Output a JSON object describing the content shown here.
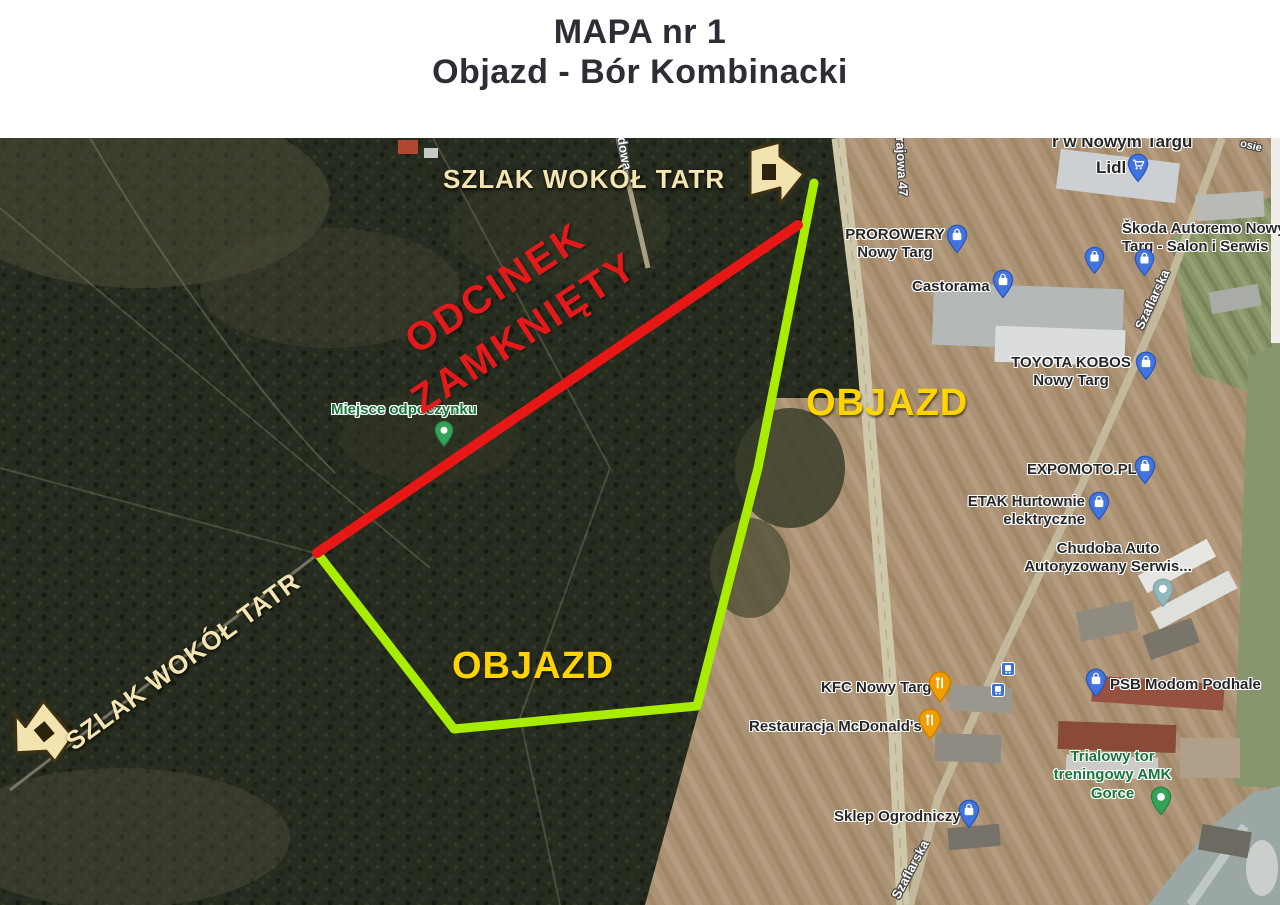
{
  "title": {
    "line1": "MAPA nr 1",
    "line2": "Objazd - Bór Kombinacki"
  },
  "annotations": {
    "trail_top": "SZLAK WOKÓŁ TATR",
    "trail_bottom": "SZLAK WOKÓŁ TATR",
    "closed_line1": "ODCINEK",
    "closed_line2": "ZAMKNIĘTY",
    "detour_east": "OBJAZD",
    "detour_south": "OBJAZD"
  },
  "colors": {
    "closed_section_line": "#e71715",
    "detour_line": "#a8ec00",
    "detour_label": "#ffd400",
    "closed_label": "#e41a1a",
    "trail_label": "#f3e5b4",
    "pin_blue": "#4274e0",
    "pin_orange": "#f09d00",
    "pin_green": "#34a357",
    "pin_teal": "#93b7bd",
    "green_label": "#17763a"
  },
  "poi": [
    {
      "text": "r w Nowym Targu"
    },
    {
      "text": "Lidl"
    },
    {
      "text": "Škoda Autoremo Nowy\nTarg - Salon i Serwis"
    },
    {
      "text": "PROROWERY\nNowy Targ"
    },
    {
      "text": "Castorama"
    },
    {
      "text": "TOYOTA KOBOS\nNowy Targ"
    },
    {
      "text": "EXPOMOTO.PL"
    },
    {
      "text": "ETAK Hurtownie\nelektryczne"
    },
    {
      "text": "Chudoba Auto\nAutoryzowany Serwis..."
    },
    {
      "text": "KFC Nowy Targ"
    },
    {
      "text": "Restauracja McDonald's"
    },
    {
      "text": "PSB Modom Podhale"
    },
    {
      "text": "Trialowy tor\ntreningowy AMK Gorce"
    },
    {
      "text": "Sklep Ogrodniczy"
    },
    {
      "text": "Miejsce odpoczynku"
    }
  ],
  "streets": [
    {
      "name": "krajowa 47"
    },
    {
      "name": "Szaflarska"
    },
    {
      "name": "Szaflarska"
    },
    {
      "name": "dowa"
    },
    {
      "name": "osie"
    }
  ]
}
